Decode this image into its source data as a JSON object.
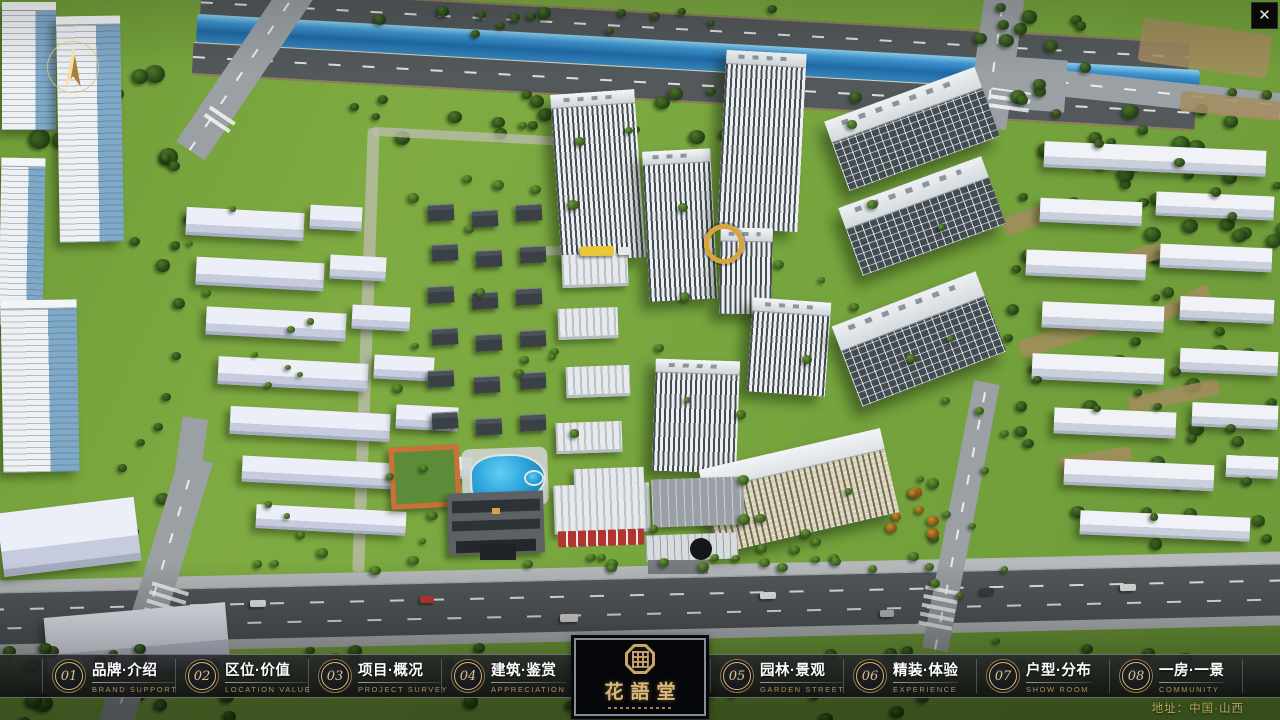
{
  "window": {
    "close_glyph": "✕"
  },
  "nav": {
    "items": [
      {
        "number": "01",
        "title": "品牌·介绍",
        "subtitle": "BRAND SUPPORT"
      },
      {
        "number": "02",
        "title": "区位·价值",
        "subtitle": "LOCATION VALUE"
      },
      {
        "number": "03",
        "title": "项目·概况",
        "subtitle": "PROJECT SURVEY"
      },
      {
        "number": "04",
        "title": "建筑·鉴赏",
        "subtitle": "APPRECIATION"
      },
      {
        "number": "05",
        "title": "园林·景观",
        "subtitle": "GARDEN STREET"
      },
      {
        "number": "06",
        "title": "精装·体验",
        "subtitle": "EXPERIENCE"
      },
      {
        "number": "07",
        "title": "户型·分布",
        "subtitle": "SHOW ROOM"
      },
      {
        "number": "08",
        "title": "一房·一景",
        "subtitle": "COMMUNITY"
      }
    ]
  },
  "logo": {
    "name": "花語堂"
  },
  "footer": {
    "address": "地址：中国·山西"
  },
  "palette": {
    "gold": "#d9a43a",
    "accent_gold": "#c9a96a",
    "bar_bg": "#17191c",
    "river_blue": "#2f86c2",
    "grass": "#77a53e",
    "tree_dark": "#2f4a1e",
    "road_light": "#9aa0a4",
    "asphalt": "#53585b",
    "building_white": "#e8ecef"
  }
}
